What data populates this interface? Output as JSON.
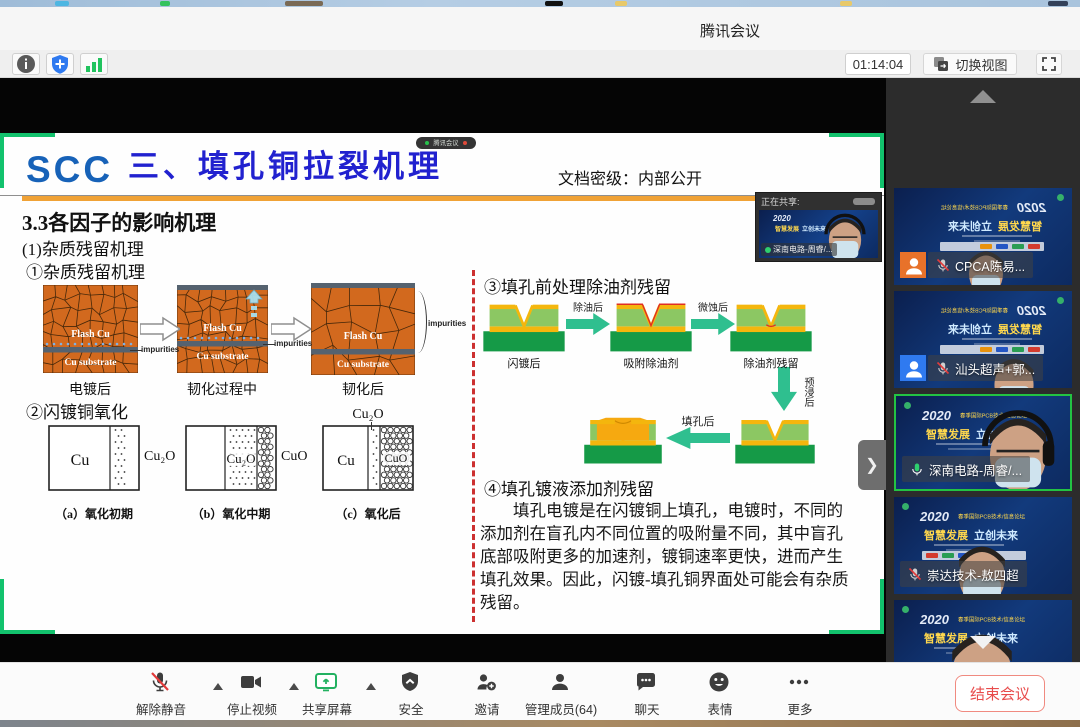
{
  "colors": {
    "accent_green": "#23c343",
    "share_border_green": "#12c26d",
    "title_blue": "#2121cf",
    "logo_blue": "#1762b8",
    "orange_rule": "#f0a236",
    "end_red": "#e84c4c"
  },
  "titlebar": {
    "title": "腾讯会议"
  },
  "statusbar": {
    "timer": "01:14:04",
    "switch_view_label": "切换视图"
  },
  "share_badge": {
    "label": "腾讯会议"
  },
  "slide": {
    "logo": "SCC",
    "title": "三、填孔铜拉裂机理",
    "classification": "文档密级：内部公开",
    "section": "3.3各因子的影响机理",
    "sub1": "(1)杂质残留机理",
    "sub1a": "①杂质残留机理",
    "grain": {
      "flash_cu": "Flash Cu",
      "cu_substrate": "Cu substrate",
      "impurities": "impurities",
      "captions": [
        "电镀后",
        "韧化过程中",
        "韧化后"
      ]
    },
    "sub2": "②闪镀铜氧化",
    "oxidation": {
      "cu": "Cu",
      "cu2o": "Cu₂O",
      "cuo": "CuO",
      "captions": [
        "（a）氧化初期",
        "（b）氧化中期",
        "（c）氧化后"
      ]
    },
    "sub3": "③填孔前处理除油剂残留",
    "via": {
      "captions_row1": [
        "闪镀后",
        "吸附除油剂",
        "除油剂残留"
      ],
      "arrow_labels": {
        "after_degrease": "除油后",
        "after_microetch": "微蚀后",
        "after_predip": "预浸后",
        "after_fill": "填孔后"
      }
    },
    "sub4": "④填孔镀液添加剂残留",
    "paragraph": "填孔电镀是在闪镀铜上填孔，电镀时，不同的添加剂在盲孔内不同位置的吸附量不同，其中盲孔底部吸附更多的加速剂，镀铜速率更快，进而产生填孔效果。因此，闪镀-填孔铜界面处可能会有杂质残留。"
  },
  "share_preview": {
    "label": "正在共享:",
    "participant": "深南电路-周睿/..."
  },
  "sidebar": {
    "participants": [
      {
        "name": "CPCA陈易...",
        "muted": true,
        "active": false,
        "avatar": "#e8722a"
      },
      {
        "name": "汕头超声+郭...",
        "muted": true,
        "active": false,
        "avatar": "#2f7af0"
      },
      {
        "name": "深南电路-周睿/...",
        "muted": false,
        "active": true,
        "avatar": null
      },
      {
        "name": "崇达技术-敖四超",
        "muted": true,
        "active": false,
        "avatar": null
      },
      {
        "name": "珠海方正笪志盛",
        "muted": true,
        "active": false,
        "avatar": null
      }
    ],
    "thumb_bg": {
      "year": "2020",
      "forum": "春季国际PCB技术/信息论坛",
      "slogan_a": "智慧发展",
      "slogan_b": "立创未来"
    }
  },
  "toolbar": {
    "items": [
      {
        "id": "unmute",
        "label": "解除静音",
        "icon": "mic-muted-icon",
        "caret": true
      },
      {
        "id": "stop-video",
        "label": "停止视频",
        "icon": "camera-icon",
        "caret": true
      },
      {
        "id": "share-screen",
        "label": "共享屏幕",
        "icon": "screen-share-icon",
        "caret": true
      },
      {
        "id": "security",
        "label": "安全",
        "icon": "shield-icon",
        "caret": false
      },
      {
        "id": "invite",
        "label": "邀请",
        "icon": "person-add-icon",
        "caret": false
      },
      {
        "id": "members",
        "label": "管理成员(64)",
        "icon": "people-icon",
        "caret": false
      },
      {
        "id": "chat",
        "label": "聊天",
        "icon": "chat-icon",
        "caret": false
      },
      {
        "id": "emoji",
        "label": "表情",
        "icon": "smiley-icon",
        "caret": false
      },
      {
        "id": "more",
        "label": "更多",
        "icon": "more-icon",
        "caret": false
      }
    ],
    "end_button": "结束会议"
  }
}
